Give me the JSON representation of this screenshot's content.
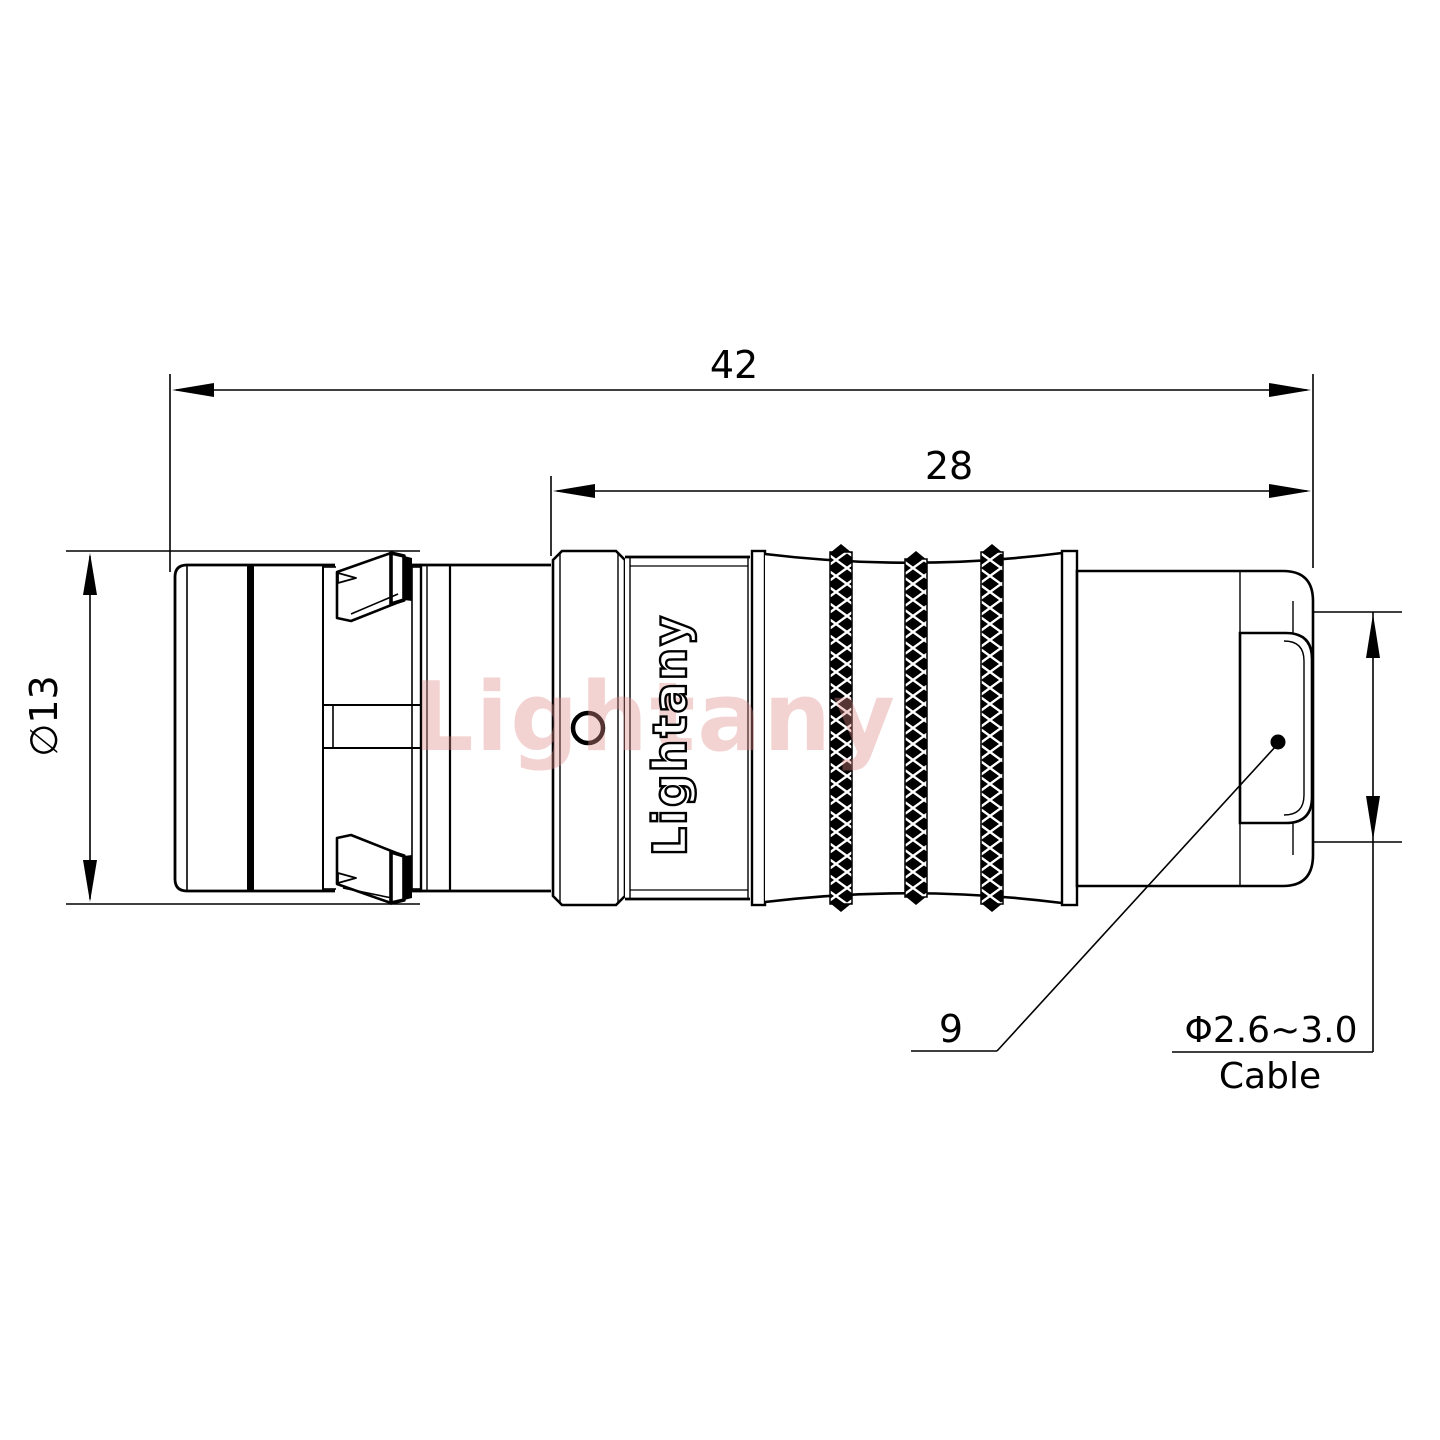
{
  "drawing": {
    "labels": {
      "overall_length": "42",
      "mid_length": "28",
      "front_diameter": "∅13",
      "shell_size": "9",
      "cable_range": "Φ2.6~3.0",
      "cable_word": "Cable"
    },
    "branding": {
      "logo": "Lightany",
      "watermark": "Lightany"
    },
    "colors": {
      "line": "#000000",
      "watermark": "#e08a8a",
      "background": "#ffffff"
    }
  }
}
